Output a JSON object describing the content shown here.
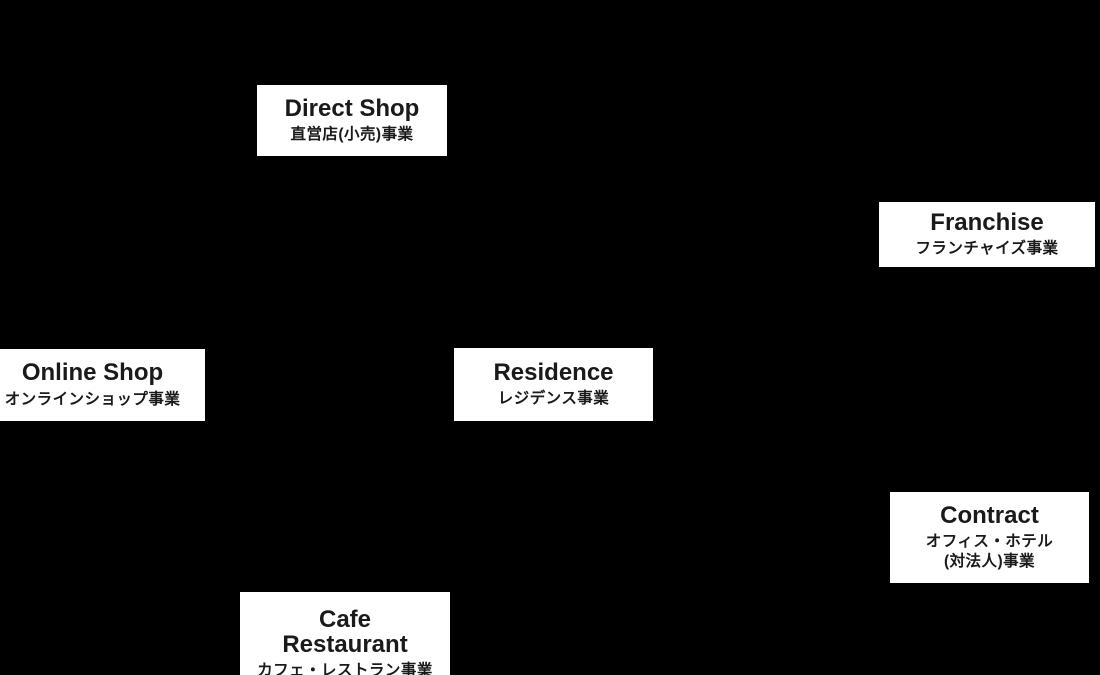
{
  "colors": {
    "background": "#000000",
    "tile_background": "#ffffff",
    "text": "#1a1a1a"
  },
  "tiles": [
    {
      "name": "direct-shop",
      "title": "Direct Shop",
      "subtitle": "直営店(小売)事業"
    },
    {
      "name": "franchise",
      "title": "Franchise",
      "subtitle": "フランチャイズ事業"
    },
    {
      "name": "online-shop",
      "title": "Online Shop",
      "subtitle": "オンラインショップ事業"
    },
    {
      "name": "residence",
      "title": "Residence",
      "subtitle": "レジデンス事業"
    },
    {
      "name": "contract",
      "title": "Contract",
      "subtitle": "オフィス・ホテル\n(対法人)事業"
    },
    {
      "name": "cafe-restaurant",
      "title": "Cafe\nRestaurant",
      "subtitle": "カフェ・レストラン事業"
    }
  ]
}
